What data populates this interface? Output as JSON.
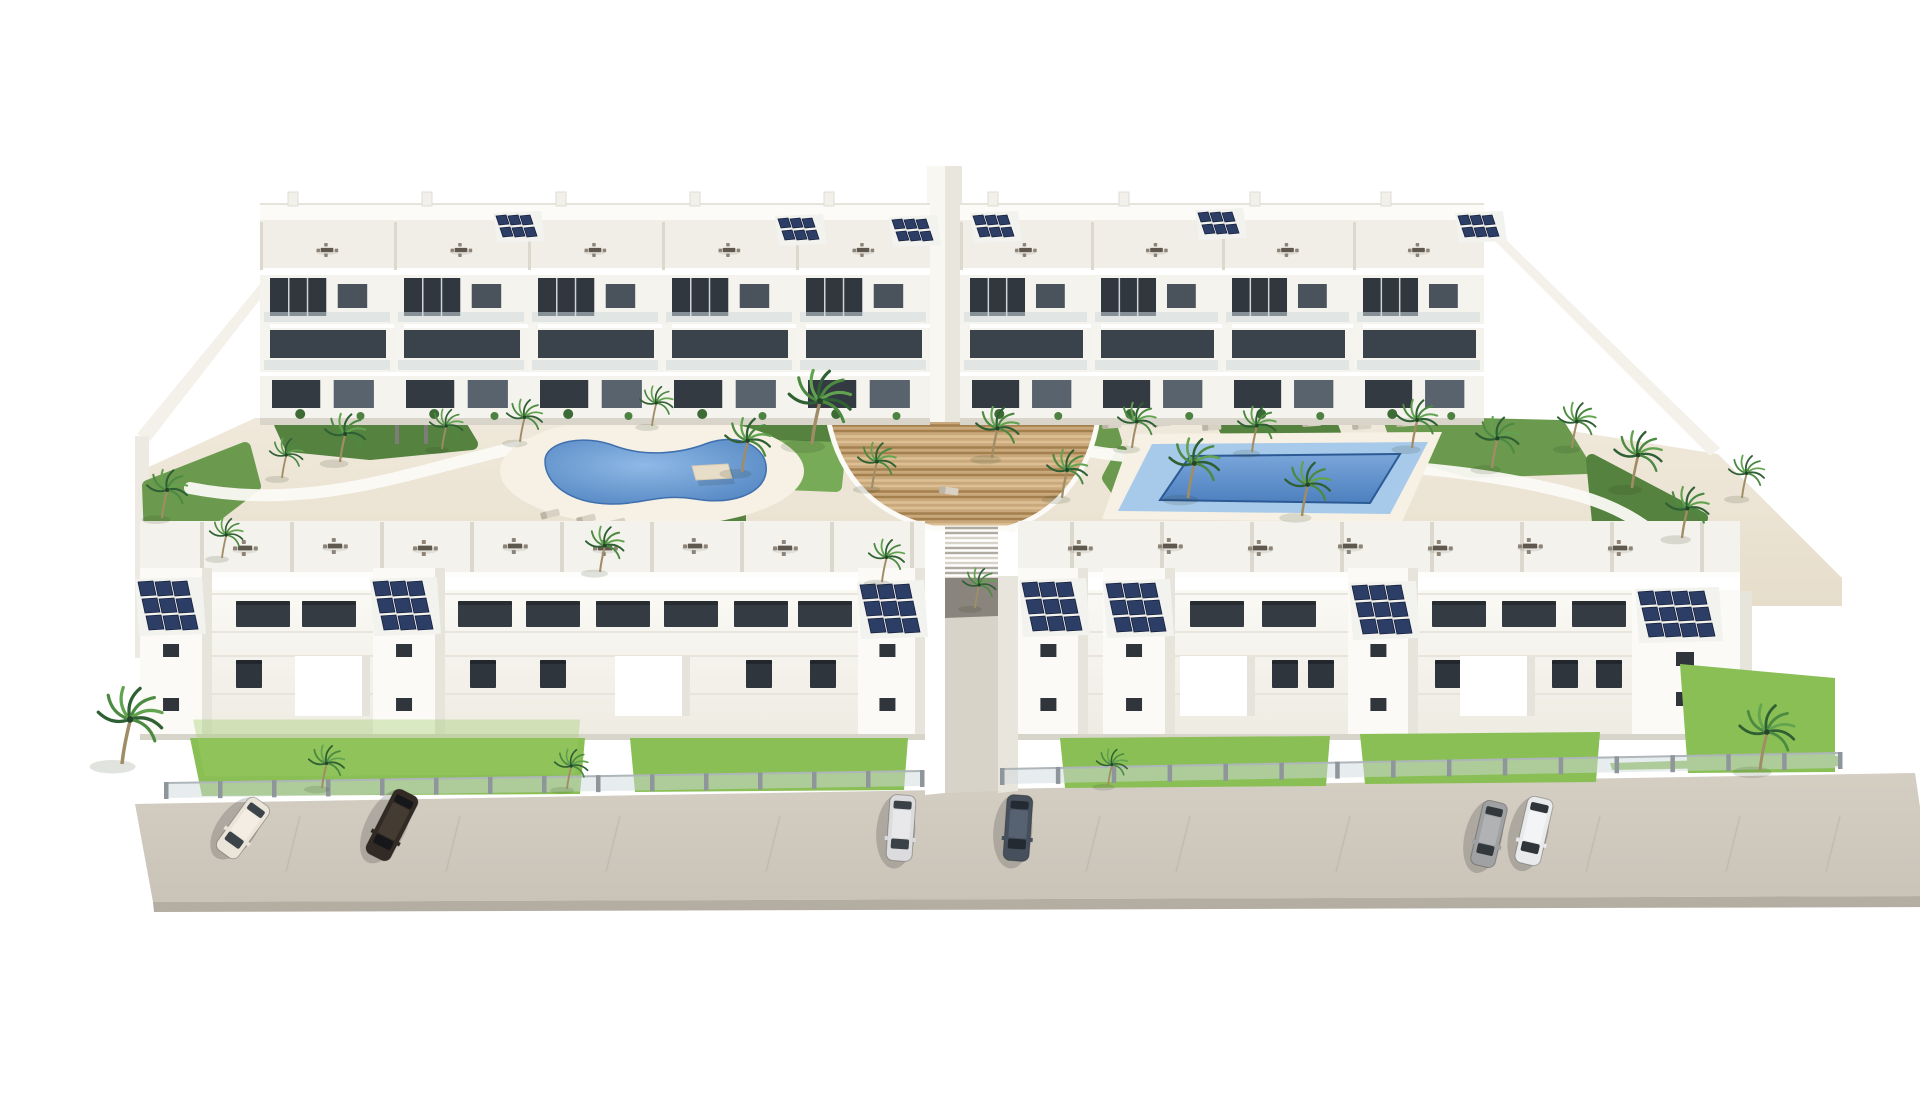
{
  "meta": {
    "title": "Aerial 3D architectural rendering of a white Mediterranean apartment complex with two communal pools, gardens, palm trees, rooftop solar panels and street parking",
    "scene_type": "architectural-render",
    "counts": {
      "apartment_blocks": 4,
      "pools": 2,
      "cars": 6,
      "solar_arrays": 13,
      "palm_trees": 30
    }
  },
  "palette": {
    "white": "#ffffff",
    "warm_white": "#f6f4ee",
    "shadow_white": "#e8e5dc",
    "ground_sand": "#ece4d4",
    "deck_sand": "#f6f1e4",
    "road": "#cfc9be",
    "road_edge": "#b3ada2",
    "glass_dark": "#343b42",
    "glass_mid": "#59636e",
    "solar_blue": "#2c3d66",
    "pool_deep": "#4b7fbd",
    "pool_light": "#a7c9ea",
    "wood": "#c9a87c",
    "wood_line": "#a5804f",
    "grass": "#8abf55",
    "garden_green": "#5d8a45",
    "palm_green": "#2f6034"
  },
  "road": {
    "surface": "95,788 1875,757 1893,880 113,886",
    "edge": "113,886 1893,880 1895,891 114,896",
    "dash_xs": [
      260,
      420,
      580,
      740,
      1060,
      1150,
      1310,
      1560,
      1700,
      1800
    ]
  },
  "fences": [
    {
      "x1": 126,
      "y1": 780,
      "x2": 882,
      "y2": 768,
      "posts": 14
    },
    {
      "x1": 962,
      "y1": 766,
      "x2": 1800,
      "y2": 750,
      "posts": 15
    }
  ],
  "grass_patches": [
    "150,722 545,722 540,778 162,780",
    "590,722 868,722 864,774 595,776",
    "1020,722 1290,720 1286,770 1025,772",
    "1320,718 1560,716 1556,766 1325,768",
    "1640,648 1795,662 1795,756 1648,757",
    "1570,747 1798,740 1798,750 1572,754"
  ],
  "garden_beds": [
    {
      "pts": "240,408 420,408 432,428 330,438 250,430",
      "fill": "#55823f"
    },
    {
      "pts": "565,406 655,406 650,420 580,424",
      "fill": "#6b9a4f"
    },
    {
      "pts": "690,404 800,404 812,440 762,456 700,440",
      "fill": "#55823f"
    },
    {
      "pts": "975,406 1070,406 1076,426 990,430",
      "fill": "#6b9a4f"
    },
    {
      "pts": "1180,404 1290,404 1302,436 1200,440",
      "fill": "#55823f"
    },
    {
      "pts": "1350,406 1520,410 1546,452 1430,456 1360,436",
      "fill": "#6b9a4f"
    },
    {
      "pts": "1552,444 1662,502 1640,546 1558,506",
      "fill": "#55823f"
    },
    {
      "pts": "108,470 205,432 215,470 150,520 110,522",
      "fill": "#6b9a4f"
    },
    {
      "pts": "540,494 700,492 700,505 545,505",
      "fill": "#55823f"
    },
    {
      "pts": "1082,436 1110,470 1092,496 1068,462",
      "fill": "#6b9a4f"
    },
    {
      "pts": "735,430 800,432 796,470 745,468",
      "fill": "#77ab57"
    }
  ],
  "paths": [
    "M150,472 C300,502 420,432 545,420",
    "M980,416 C1120,472 1320,420 1540,480 C1610,500 1650,545 1660,582",
    "M832,404 C862,470 958,470 972,510"
  ],
  "pool_left": {
    "deck": {
      "cx": 612,
      "cy": 455,
      "rx": 152,
      "ry": 56
    },
    "water": "M505,445 C505,425 545,418 575,430 C605,441 640,438 668,427 C700,416 729,432 726,456 C723,479 690,489 655,483 C620,477 600,489 570,488 C530,487 505,468 505,445 Z"
  },
  "pool_right": {
    "deck": "1092,418 1402,416 1362,506 1062,503",
    "shelf": "1112,428 1388,426 1350,498 1078,495",
    "deep": "1150,440 1360,438 1330,487 1120,484"
  },
  "wood_deck": {
    "outline": "M788,402 C800,468 842,500 893,512 L968,512 C1012,500 1050,460 1058,402 Z",
    "stairs": {
      "x": 905,
      "y": 512,
      "w": 53,
      "h": 52
    }
  },
  "top_blocks": [
    {
      "x": 220,
      "units": 5,
      "uw": 134
    },
    {
      "x": 920,
      "units": 4,
      "uw": 131
    }
  ],
  "solar_arrays": [
    {
      "x": 456,
      "y": 200,
      "c": 3,
      "r": 2,
      "cw": 12,
      "ch": 10
    },
    {
      "x": 738,
      "y": 203,
      "c": 3,
      "r": 2,
      "cw": 12,
      "ch": 10
    },
    {
      "x": 852,
      "y": 204,
      "c": 3,
      "r": 2,
      "cw": 12,
      "ch": 10
    },
    {
      "x": 933,
      "y": 200,
      "c": 3,
      "r": 2,
      "cw": 12,
      "ch": 10
    },
    {
      "x": 1158,
      "y": 197,
      "c": 3,
      "r": 2,
      "cw": 12,
      "ch": 10
    },
    {
      "x": 1418,
      "y": 200,
      "c": 3,
      "r": 2,
      "cw": 12,
      "ch": 10
    },
    {
      "x": 98,
      "y": 566,
      "c": 3,
      "r": 3,
      "cw": 17,
      "ch": 15
    },
    {
      "x": 333,
      "y": 566,
      "c": 3,
      "r": 3,
      "cw": 17,
      "ch": 15
    },
    {
      "x": 820,
      "y": 569,
      "c": 3,
      "r": 3,
      "cw": 17,
      "ch": 15
    },
    {
      "x": 982,
      "y": 567,
      "c": 3,
      "r": 3,
      "cw": 17,
      "ch": 15
    },
    {
      "x": 1066,
      "y": 568,
      "c": 3,
      "r": 3,
      "cw": 17,
      "ch": 15
    },
    {
      "x": 1312,
      "y": 570,
      "c": 3,
      "r": 3,
      "cw": 17,
      "ch": 15
    },
    {
      "x": 1598,
      "y": 576,
      "c": 4,
      "r": 3,
      "cw": 17,
      "ch": 14
    }
  ],
  "rooftop_dining": [
    {
      "x": 205,
      "y": 532
    },
    {
      "x": 295,
      "y": 530
    },
    {
      "x": 385,
      "y": 532
    },
    {
      "x": 475,
      "y": 530
    },
    {
      "x": 565,
      "y": 532
    },
    {
      "x": 655,
      "y": 530
    },
    {
      "x": 745,
      "y": 532
    },
    {
      "x": 1040,
      "y": 532
    },
    {
      "x": 1130,
      "y": 530
    },
    {
      "x": 1220,
      "y": 532
    },
    {
      "x": 1310,
      "y": 530
    },
    {
      "x": 1400,
      "y": 532
    },
    {
      "x": 1490,
      "y": 530
    },
    {
      "x": 1580,
      "y": 532
    }
  ],
  "canopies": [
    {
      "x": 332,
      "y": 512,
      "w": 40
    },
    {
      "x": 700,
      "y": 512,
      "w": 40
    },
    {
      "x": 1178,
      "y": 510,
      "w": 40
    },
    {
      "x": 1458,
      "y": 510,
      "w": 40
    },
    {
      "x": 1163,
      "y": 390,
      "w": 30
    },
    {
      "x": 1233,
      "y": 388,
      "w": 30
    },
    {
      "x": 652,
      "y": 450,
      "w": 36
    }
  ],
  "loungers": [
    {
      "x": 536,
      "y": 502,
      "a": -14
    },
    {
      "x": 566,
      "y": 506,
      "a": -14
    },
    {
      "x": 500,
      "y": 497,
      "a": -14
    },
    {
      "x": 1062,
      "y": 406,
      "a": -4
    },
    {
      "x": 1112,
      "y": 404,
      "a": -4
    },
    {
      "x": 1162,
      "y": 408,
      "a": -4
    },
    {
      "x": 1262,
      "y": 404,
      "a": -4
    },
    {
      "x": 1312,
      "y": 407,
      "a": -4
    },
    {
      "x": 1356,
      "y": 404,
      "a": -4
    },
    {
      "x": 900,
      "y": 470,
      "a": 8
    }
  ],
  "palms": [
    {
      "x": 300,
      "y": 446,
      "s": 0.85
    },
    {
      "x": 402,
      "y": 433,
      "s": 0.7
    },
    {
      "x": 480,
      "y": 426,
      "s": 0.75
    },
    {
      "x": 612,
      "y": 410,
      "s": 0.7
    },
    {
      "x": 702,
      "y": 456,
      "s": 0.95
    },
    {
      "x": 772,
      "y": 428,
      "s": 1.3
    },
    {
      "x": 832,
      "y": 472,
      "s": 0.8
    },
    {
      "x": 952,
      "y": 442,
      "s": 0.9
    },
    {
      "x": 1022,
      "y": 482,
      "s": 0.85
    },
    {
      "x": 1092,
      "y": 432,
      "s": 0.8
    },
    {
      "x": 1148,
      "y": 482,
      "s": 1.05
    },
    {
      "x": 1212,
      "y": 436,
      "s": 0.8
    },
    {
      "x": 1262,
      "y": 500,
      "s": 0.95
    },
    {
      "x": 1372,
      "y": 432,
      "s": 0.85
    },
    {
      "x": 1452,
      "y": 452,
      "s": 0.9
    },
    {
      "x": 1532,
      "y": 432,
      "s": 0.8
    },
    {
      "x": 1592,
      "y": 472,
      "s": 1.0
    },
    {
      "x": 1642,
      "y": 522,
      "s": 0.9
    },
    {
      "x": 122,
      "y": 502,
      "s": 0.85
    },
    {
      "x": 182,
      "y": 542,
      "s": 0.7
    },
    {
      "x": 242,
      "y": 462,
      "s": 0.7
    },
    {
      "x": 1702,
      "y": 482,
      "s": 0.75
    },
    {
      "x": 560,
      "y": 556,
      "s": 0.8
    },
    {
      "x": 842,
      "y": 566,
      "s": 0.75
    },
    {
      "x": 935,
      "y": 592,
      "s": 0.7
    },
    {
      "x": 82,
      "y": 748,
      "s": 1.35
    },
    {
      "x": 282,
      "y": 772,
      "s": 0.75
    },
    {
      "x": 527,
      "y": 773,
      "s": 0.7
    },
    {
      "x": 1720,
      "y": 754,
      "s": 1.15
    },
    {
      "x": 1068,
      "y": 770,
      "s": 0.65
    }
  ],
  "cars": [
    {
      "name": "car-cream",
      "x": 203,
      "y": 812,
      "a": 36,
      "l": 64,
      "w": 26,
      "body": "#ebe4d9",
      "glass": "#3c4449",
      "roof": "#f3ede3"
    },
    {
      "name": "car-black",
      "x": 352,
      "y": 809,
      "a": 27,
      "l": 72,
      "w": 27,
      "body": "#322a24",
      "glass": "#15171a",
      "roof": "#443b33"
    },
    {
      "name": "car-silver",
      "x": 861,
      "y": 812,
      "a": 4,
      "l": 66,
      "w": 26,
      "body": "#dcdcde",
      "glass": "#3a4147",
      "roof": "#e8e8ea"
    },
    {
      "name": "car-darkslate",
      "x": 978,
      "y": 812,
      "a": 4,
      "l": 66,
      "w": 26,
      "body": "#46505c",
      "glass": "#232a31",
      "roof": "#566271"
    },
    {
      "name": "car-gray",
      "x": 1449,
      "y": 818,
      "a": 13,
      "l": 66,
      "w": 25,
      "body": "#9fa1a3",
      "glass": "#33383d",
      "roof": "#b0b2b4"
    },
    {
      "name": "car-white",
      "x": 1494,
      "y": 815,
      "a": 13,
      "l": 68,
      "w": 26,
      "body": "#e8eaec",
      "glass": "#2f3539",
      "roof": "#f2f4f6"
    }
  ],
  "bottom_windows": {
    "row_upper": {
      "y": 585,
      "h": 26,
      "w": 54,
      "fill": "#343b42",
      "xs": [
        196,
        262,
        418,
        486,
        556,
        624,
        694,
        758,
        1150,
        1222,
        1392,
        1462,
        1532
      ]
    },
    "row_lower": {
      "y": 644,
      "h": 28,
      "w": 26,
      "fill": "#2e353c",
      "xs": [
        196,
        430,
        500,
        706,
        770,
        1232,
        1268,
        1395,
        1512,
        1556
      ]
    }
  }
}
